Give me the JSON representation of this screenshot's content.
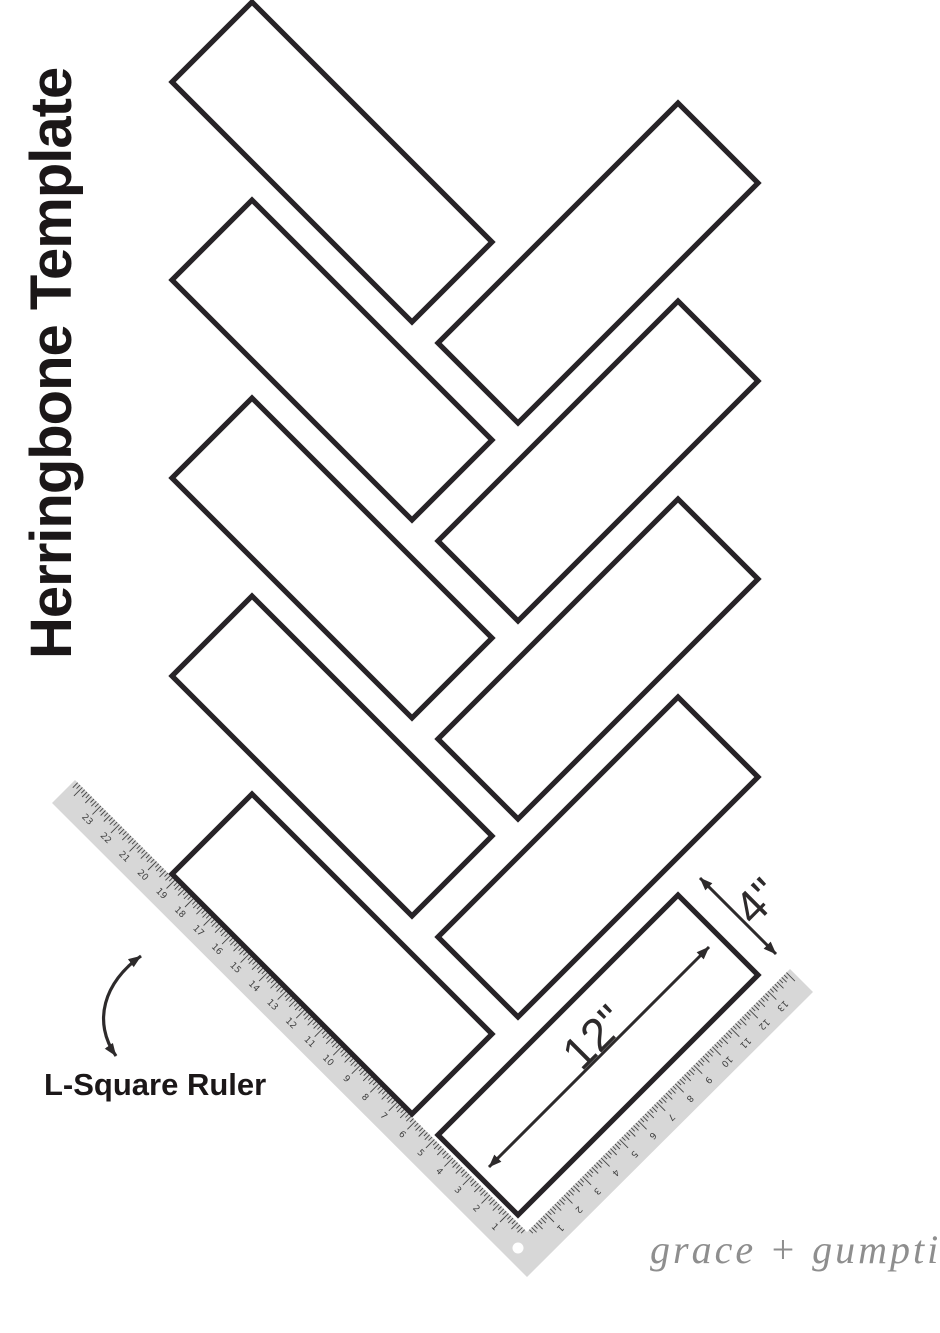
{
  "page": {
    "background": "#ffffff"
  },
  "title": "Herringbone Template",
  "labels": {
    "ruler_label": "L-Square Ruler",
    "plank_length": "12\"",
    "plank_width": "4\""
  },
  "signature": "grace + gumption",
  "pattern": {
    "plank_length_in": 12,
    "plank_width_in": 4,
    "px_per_inch": 28.3,
    "angle_deg": 45,
    "left_column": {
      "count": 5,
      "x": 172,
      "y_start": 82,
      "pitch": 198
    },
    "right_column": {
      "count": 5,
      "x": 438,
      "y_start": 343,
      "pitch": 198
    }
  },
  "ruler": {
    "px_per_inch": 26.2,
    "long_arm_numbers": [
      1,
      2,
      3,
      4,
      5,
      6,
      7,
      8,
      9,
      10,
      11,
      12,
      13,
      14,
      15,
      16,
      17,
      18,
      19,
      20,
      21,
      22,
      23
    ],
    "short_arm_numbers": [
      1,
      2,
      3,
      4,
      5,
      6,
      7,
      8,
      9,
      10,
      11,
      12,
      13
    ]
  },
  "colors": {
    "plank_outline": "#272327",
    "ruler_fill": "#d7d7d7",
    "ruler_tick": "#454545",
    "ruler_number": "#3f3f3f",
    "heading_text": "#1b1718",
    "dimension": "#2d2a2b",
    "signature": "#8e8e8e"
  }
}
